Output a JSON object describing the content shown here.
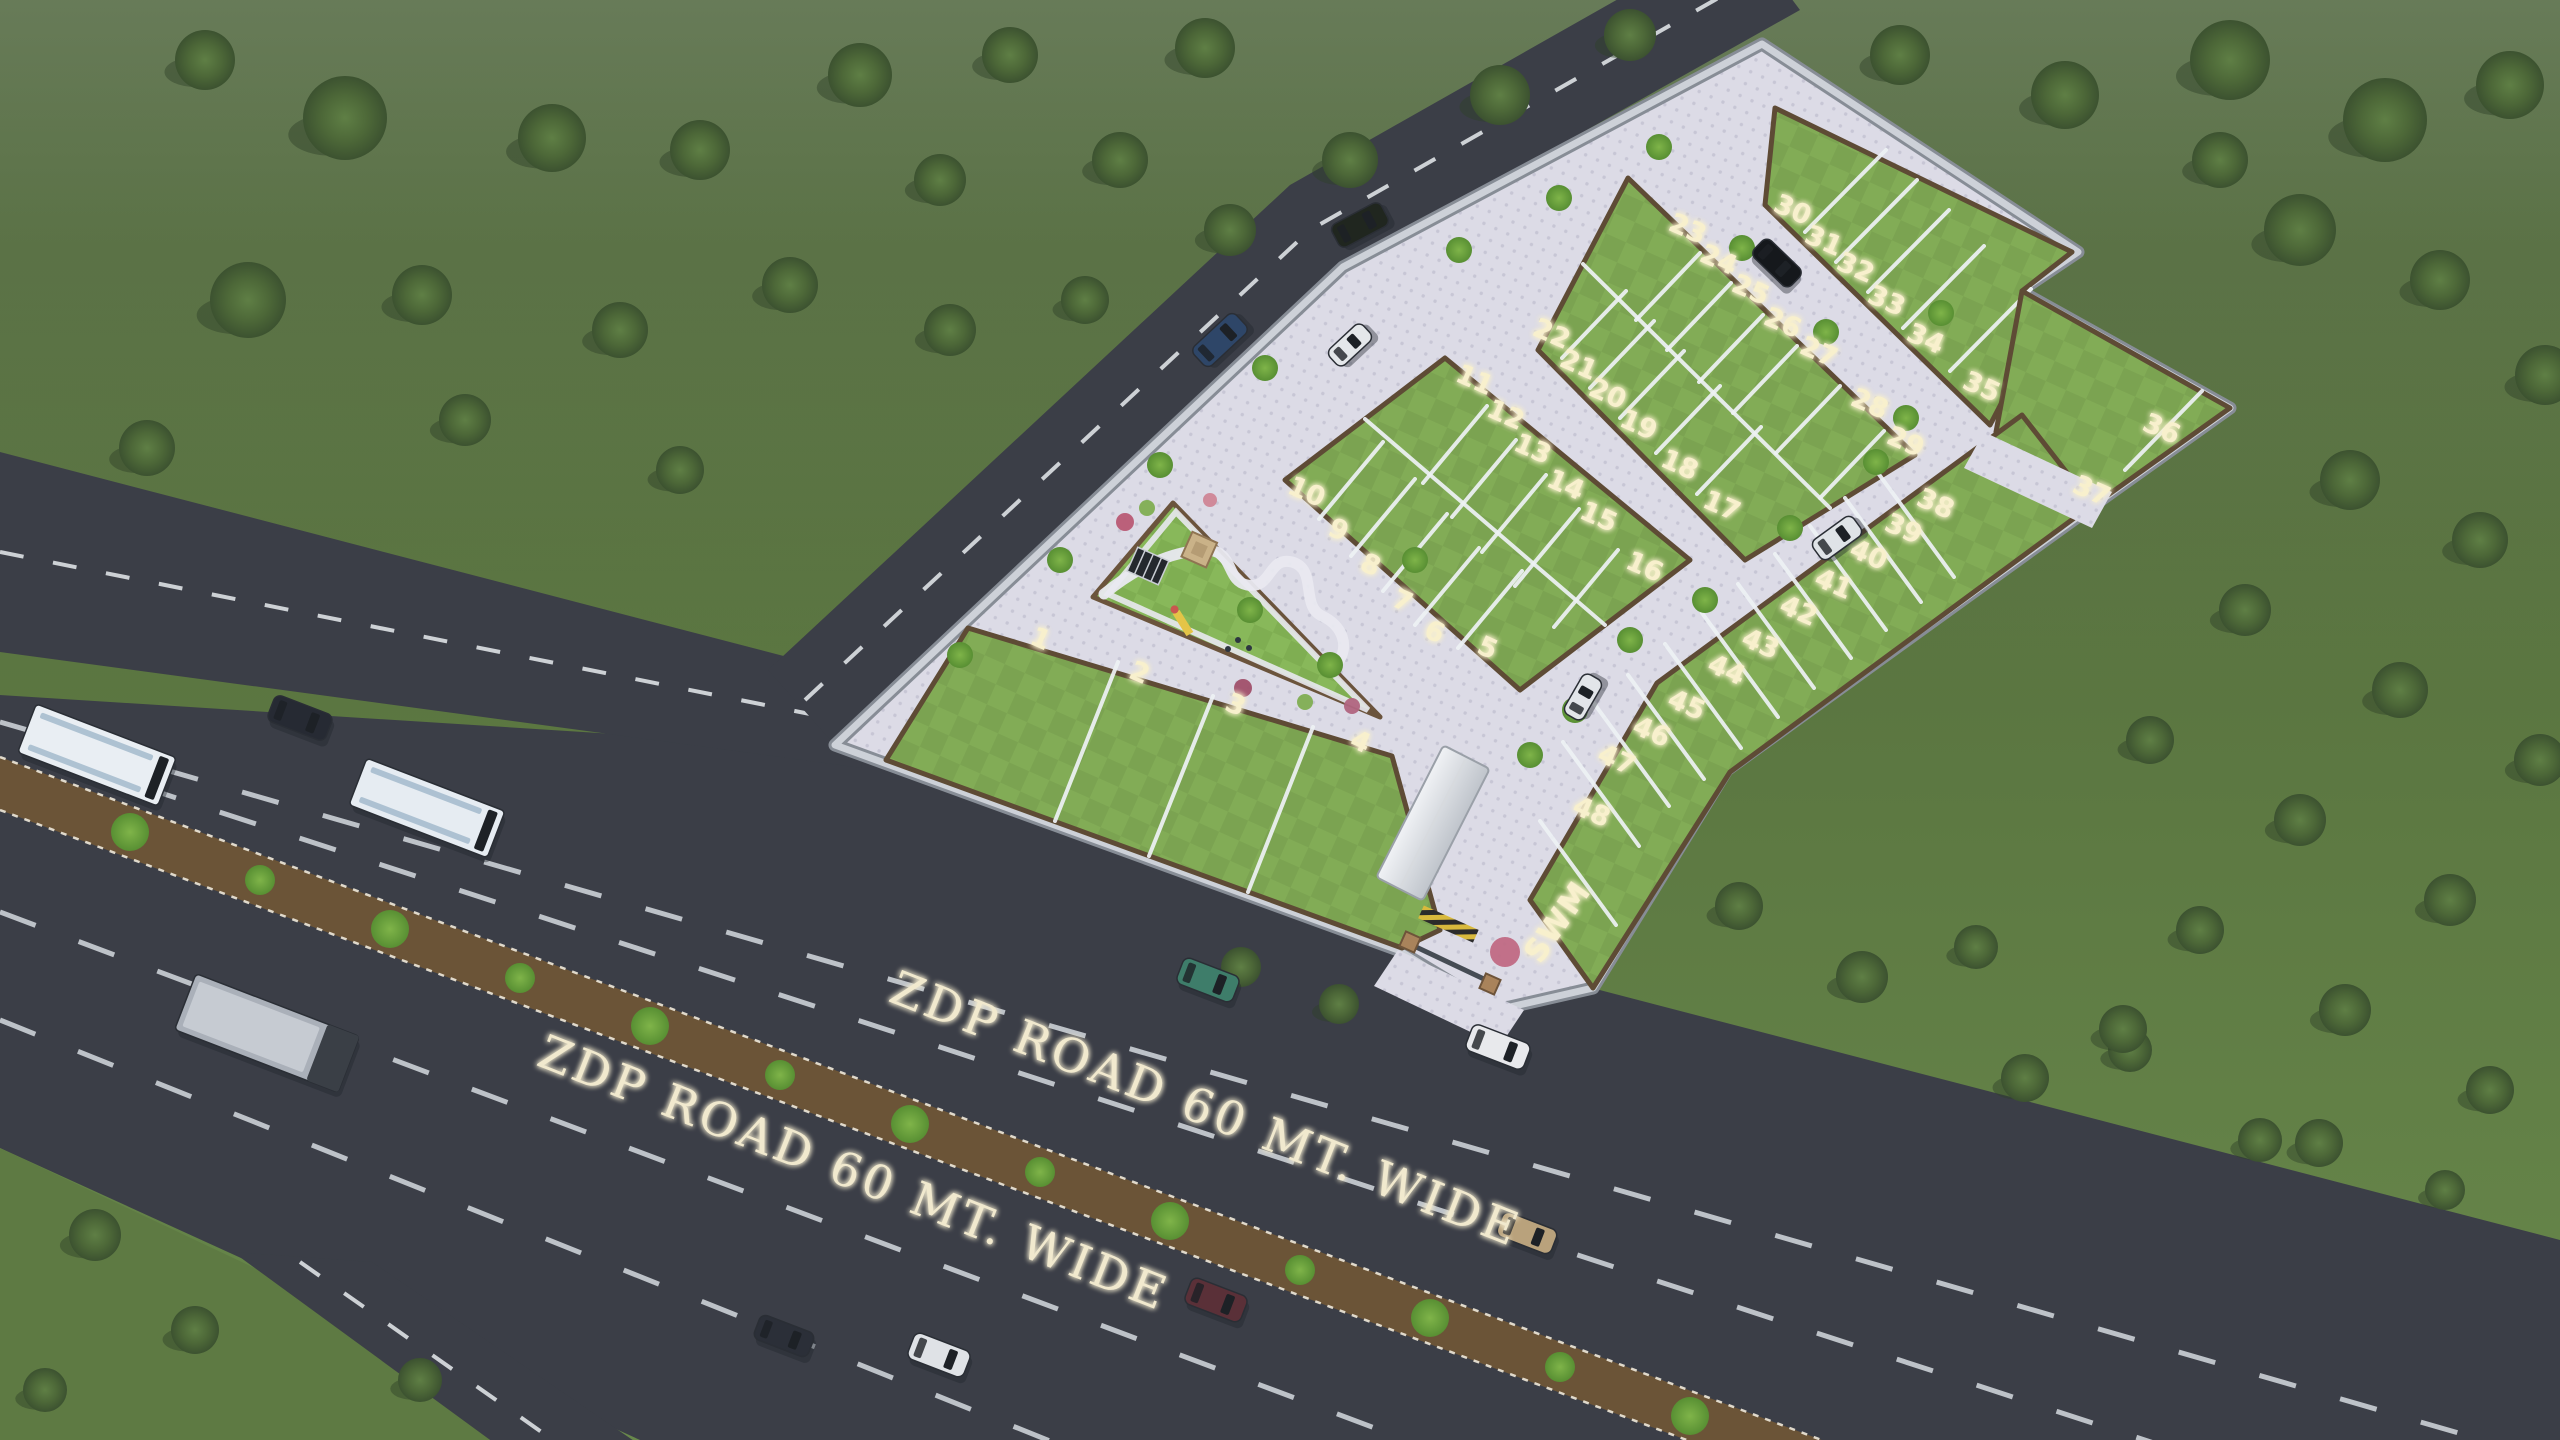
{
  "road_labels": [
    {
      "text": "ZDP ROAD 60 MT. WIDE",
      "x": 1200,
      "y": 1124,
      "rotate": 21.5
    },
    {
      "text": "ZDP ROAD 60 MT. WIDE",
      "x": 848,
      "y": 1188,
      "rotate": 21.5
    }
  ],
  "site": {
    "utility_label": {
      "text": "SWM",
      "x": 1566,
      "y": 928,
      "rotate": -55
    },
    "plot_labels": [
      {
        "n": "1",
        "x": 1037,
        "y": 647
      },
      {
        "n": "2",
        "x": 1136,
        "y": 681
      },
      {
        "n": "3",
        "x": 1232,
        "y": 713
      },
      {
        "n": "4",
        "x": 1357,
        "y": 750
      },
      {
        "n": "5",
        "x": 1484,
        "y": 656
      },
      {
        "n": "6",
        "x": 1431,
        "y": 640
      },
      {
        "n": "7",
        "x": 1399,
        "y": 609
      },
      {
        "n": "8",
        "x": 1367,
        "y": 573
      },
      {
        "n": "9",
        "x": 1335,
        "y": 538
      },
      {
        "n": "10",
        "x": 1303,
        "y": 500
      },
      {
        "n": "11",
        "x": 1471,
        "y": 388
      },
      {
        "n": "12",
        "x": 1502,
        "y": 423
      },
      {
        "n": "13",
        "x": 1529,
        "y": 457
      },
      {
        "n": "14",
        "x": 1562,
        "y": 493
      },
      {
        "n": "15",
        "x": 1595,
        "y": 525
      },
      {
        "n": "16",
        "x": 1641,
        "y": 575
      },
      {
        "n": "17",
        "x": 1718,
        "y": 514
      },
      {
        "n": "18",
        "x": 1676,
        "y": 473
      },
      {
        "n": "19",
        "x": 1635,
        "y": 433
      },
      {
        "n": "20",
        "x": 1604,
        "y": 402
      },
      {
        "n": "21",
        "x": 1575,
        "y": 373
      },
      {
        "n": "22",
        "x": 1548,
        "y": 342
      },
      {
        "n": "23",
        "x": 1684,
        "y": 237
      },
      {
        "n": "24",
        "x": 1715,
        "y": 268
      },
      {
        "n": "25",
        "x": 1747,
        "y": 298
      },
      {
        "n": "26",
        "x": 1779,
        "y": 331
      },
      {
        "n": "27",
        "x": 1815,
        "y": 360
      },
      {
        "n": "28",
        "x": 1866,
        "y": 412
      },
      {
        "n": "29",
        "x": 1902,
        "y": 450
      },
      {
        "n": "30",
        "x": 1789,
        "y": 218
      },
      {
        "n": "31",
        "x": 1820,
        "y": 249
      },
      {
        "n": "32",
        "x": 1852,
        "y": 276
      },
      {
        "n": "33",
        "x": 1883,
        "y": 309
      },
      {
        "n": "34",
        "x": 1922,
        "y": 347
      },
      {
        "n": "35",
        "x": 1978,
        "y": 395
      },
      {
        "n": "36",
        "x": 2158,
        "y": 437
      },
      {
        "n": "37",
        "x": 2088,
        "y": 499
      },
      {
        "n": "38",
        "x": 1932,
        "y": 512
      },
      {
        "n": "39",
        "x": 1900,
        "y": 537
      },
      {
        "n": "40",
        "x": 1865,
        "y": 563
      },
      {
        "n": "41",
        "x": 1830,
        "y": 592
      },
      {
        "n": "42",
        "x": 1795,
        "y": 619
      },
      {
        "n": "43",
        "x": 1757,
        "y": 652
      },
      {
        "n": "44",
        "x": 1723,
        "y": 678
      },
      {
        "n": "45",
        "x": 1683,
        "y": 713
      },
      {
        "n": "46",
        "x": 1648,
        "y": 740
      },
      {
        "n": "47",
        "x": 1613,
        "y": 768
      },
      {
        "n": "48",
        "x": 1588,
        "y": 820
      }
    ]
  },
  "colors": {
    "grass_top": "#4f663a",
    "grass_mid": "#5a7540",
    "grass_bottom": "#68884b",
    "plot_green": "#7ba351",
    "plot_green_alt": "#82ac56",
    "pavement": "#dcdbe6",
    "pavement_dot": "#c7c6d5",
    "asphalt": "#3b3e47",
    "median_brown": "#6b5437",
    "wall_gray": "#cdd1d8",
    "planter_brown": "#5e4b35",
    "label_cream": "#f8f0cd",
    "road_label_cream": "#f1e9ce"
  },
  "vehicles": [
    {
      "name": "bus",
      "x": 97,
      "y": 755,
      "w": 150,
      "h": 52,
      "r": 21,
      "c": "#e9eef3"
    },
    {
      "name": "bus",
      "x": 427,
      "y": 808,
      "w": 148,
      "h": 50,
      "r": 21,
      "c": "#e6ecf2"
    },
    {
      "name": "car",
      "x": 300,
      "y": 718,
      "w": 62,
      "h": 28,
      "r": 21,
      "c": "#262a33"
    },
    {
      "name": "car",
      "x": 1208,
      "y": 980,
      "w": 60,
      "h": 28,
      "r": 21,
      "c": "#3e7d6a"
    },
    {
      "name": "car",
      "x": 1498,
      "y": 1047,
      "w": 62,
      "h": 28,
      "r": 21,
      "c": "#e8e9ec"
    },
    {
      "name": "car",
      "x": 1216,
      "y": 1300,
      "w": 60,
      "h": 28,
      "r": 21,
      "c": "#5a3038"
    },
    {
      "name": "car",
      "x": 1527,
      "y": 1233,
      "w": 58,
      "h": 26,
      "r": 21,
      "c": "#b9a27c"
    },
    {
      "name": "car",
      "x": 939,
      "y": 1355,
      "w": 60,
      "h": 28,
      "r": 21,
      "c": "#dfe2e6"
    },
    {
      "name": "car",
      "x": 784,
      "y": 1336,
      "w": 58,
      "h": 26,
      "r": 21,
      "c": "#2b2f38"
    },
    {
      "name": "truck",
      "x": 267,
      "y": 1033,
      "w": 175,
      "h": 60,
      "r": 21,
      "c": "#aab0b9"
    },
    {
      "name": "car",
      "x": 1220,
      "y": 340,
      "w": 58,
      "h": 26,
      "r": -43,
      "c": "#2e4668"
    },
    {
      "name": "car",
      "x": 1360,
      "y": 225,
      "w": 56,
      "h": 26,
      "r": -28,
      "c": "#20261f"
    },
    {
      "name": "car",
      "x": 1350,
      "y": 345,
      "w": 46,
      "h": 22,
      "r": -43,
      "c": "#e4e7ea"
    },
    {
      "name": "car",
      "x": 1777,
      "y": 263,
      "w": 52,
      "h": 24,
      "r": 44,
      "c": "#15181c"
    },
    {
      "name": "car",
      "x": 1837,
      "y": 538,
      "w": 50,
      "h": 24,
      "r": -36,
      "c": "#dfe3e7"
    },
    {
      "name": "car",
      "x": 1583,
      "y": 697,
      "w": 46,
      "h": 22,
      "r": -60,
      "c": "#e2e5e9"
    }
  ],
  "trees": [
    [
      205,
      60,
      30
    ],
    [
      345,
      118,
      42
    ],
    [
      552,
      138,
      34
    ],
    [
      248,
      300,
      38
    ],
    [
      422,
      295,
      30
    ],
    [
      147,
      448,
      28
    ],
    [
      700,
      150,
      30
    ],
    [
      860,
      75,
      32
    ],
    [
      1010,
      55,
      28
    ],
    [
      1205,
      48,
      30
    ],
    [
      940,
      180,
      26
    ],
    [
      1120,
      160,
      28
    ],
    [
      790,
      285,
      28
    ],
    [
      620,
      330,
      28
    ],
    [
      465,
      420,
      26
    ],
    [
      950,
      330,
      26
    ],
    [
      1085,
      300,
      24
    ],
    [
      680,
      470,
      24
    ],
    [
      1230,
      230,
      26
    ],
    [
      1350,
      160,
      28
    ],
    [
      1500,
      95,
      30
    ],
    [
      1630,
      35,
      26
    ],
    [
      1900,
      55,
      30
    ],
    [
      2065,
      95,
      34
    ],
    [
      2230,
      60,
      40
    ],
    [
      2385,
      120,
      42
    ],
    [
      2510,
      85,
      34
    ],
    [
      2300,
      230,
      36
    ],
    [
      2440,
      280,
      30
    ],
    [
      2545,
      375,
      30
    ],
    [
      2220,
      160,
      28
    ],
    [
      2350,
      480,
      30
    ],
    [
      2480,
      540,
      28
    ],
    [
      2245,
      610,
      26
    ],
    [
      2400,
      690,
      28
    ],
    [
      2540,
      760,
      26
    ],
    [
      2150,
      740,
      24
    ],
    [
      2300,
      820,
      26
    ],
    [
      2450,
      900,
      26
    ],
    [
      2200,
      930,
      24
    ],
    [
      2345,
      1010,
      26
    ],
    [
      2490,
      1090,
      24
    ],
    [
      2130,
      1050,
      22
    ],
    [
      2260,
      1140,
      22
    ],
    [
      95,
      1235,
      26
    ],
    [
      195,
      1330,
      24
    ],
    [
      45,
      1390,
      22
    ],
    [
      420,
      1380,
      22
    ],
    [
      1739,
      906,
      24
    ],
    [
      1862,
      977,
      26
    ],
    [
      1976,
      947,
      22
    ],
    [
      2025,
      1078,
      24
    ],
    [
      2123,
      1029,
      24
    ],
    [
      2319,
      1143,
      24
    ],
    [
      2445,
      1190,
      20
    ],
    [
      1339,
      1004,
      20
    ],
    [
      1241,
      967,
      20
    ]
  ],
  "median_trees": [
    [
      130,
      832
    ],
    [
      260,
      880
    ],
    [
      390,
      929
    ],
    [
      520,
      978
    ],
    [
      650,
      1026
    ],
    [
      780,
      1075
    ],
    [
      910,
      1124
    ],
    [
      1040,
      1172
    ],
    [
      1170,
      1221
    ],
    [
      1300,
      1270
    ],
    [
      1430,
      1318
    ],
    [
      1560,
      1367
    ],
    [
      1690,
      1416
    ]
  ],
  "site_bushes": [
    [
      960,
      655
    ],
    [
      1060,
      560
    ],
    [
      1160,
      465
    ],
    [
      1265,
      368
    ],
    [
      1459,
      250
    ],
    [
      1559,
      198
    ],
    [
      1659,
      147
    ],
    [
      1742,
      248
    ],
    [
      1826,
      332
    ],
    [
      1906,
      418
    ],
    [
      1705,
      600
    ],
    [
      1790,
      528
    ],
    [
      1876,
      462
    ],
    [
      1530,
      755
    ],
    [
      1575,
      710
    ],
    [
      1250,
      610
    ],
    [
      1330,
      665
    ],
    [
      1415,
      560
    ],
    [
      1630,
      640
    ],
    [
      1941,
      313
    ]
  ],
  "flower_bushes": [
    {
      "x": 1125,
      "y": 522,
      "r": 9,
      "c": "#b85a74"
    },
    {
      "x": 1147,
      "y": 508,
      "r": 8,
      "c": "#7fae52"
    },
    {
      "x": 1243,
      "y": 688,
      "r": 9,
      "c": "#a0506a"
    },
    {
      "x": 1305,
      "y": 702,
      "r": 8,
      "c": "#7fae52"
    },
    {
      "x": 1352,
      "y": 706,
      "r": 8,
      "c": "#b0657f"
    },
    {
      "x": 1505,
      "y": 952,
      "r": 15,
      "c": "#c06a84"
    },
    {
      "x": 1210,
      "y": 500,
      "r": 7,
      "c": "#cf8696"
    }
  ]
}
